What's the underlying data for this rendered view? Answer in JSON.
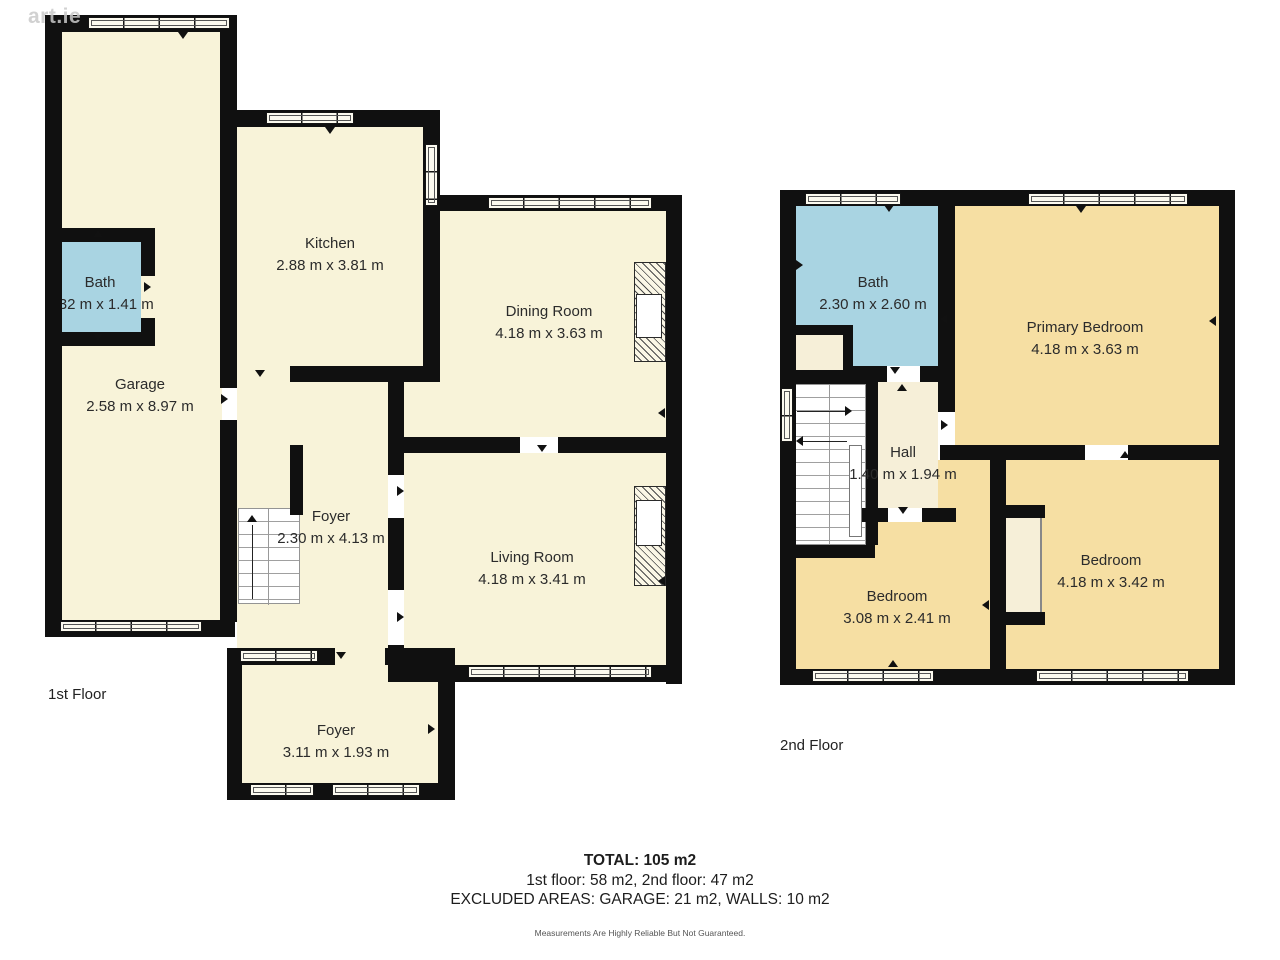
{
  "watermark": "art.ie",
  "colors": {
    "wall": "#101010",
    "floor_cream": "#f8f3d9",
    "floor_gold": "#f6dfa3",
    "bath_blue": "#a9d4e2",
    "hall_light": "#f6efd8"
  },
  "floors": [
    {
      "label": "1st Floor",
      "rooms": [
        {
          "name": "Garage",
          "dims": "2.58 m x 8.97 m"
        },
        {
          "name": "Bath",
          "dims": "1.32 m x 1.41 m"
        },
        {
          "name": "Kitchen",
          "dims": "2.88 m x 3.81 m"
        },
        {
          "name": "Dining Room",
          "dims": "4.18 m x 3.63 m"
        },
        {
          "name": "Foyer",
          "dims": "2.30 m x 4.13 m"
        },
        {
          "name": "Living Room",
          "dims": "4.18 m x 3.41 m"
        },
        {
          "name": "Foyer",
          "dims": "3.11 m x 1.93 m"
        }
      ]
    },
    {
      "label": "2nd Floor",
      "rooms": [
        {
          "name": "Bath",
          "dims": "2.30 m x 2.60 m"
        },
        {
          "name": "Primary Bedroom",
          "dims": "4.18 m x 3.63 m"
        },
        {
          "name": "Hall",
          "dims": "1.40 m x 1.94 m"
        },
        {
          "name": "Bedroom",
          "dims": "3.08 m x 2.41 m"
        },
        {
          "name": "Bedroom",
          "dims": "4.18 m x 3.42 m"
        }
      ]
    }
  ],
  "summary": {
    "total": "TOTAL: 105 m2",
    "floor_breakdown": "1st floor: 58 m2, 2nd floor: 47 m2",
    "excluded": "EXCLUDED AREAS: GARAGE: 21 m2, WALLS: 10 m2",
    "disclaimer": "Measurements Are Highly Reliable But Not Guaranteed."
  }
}
